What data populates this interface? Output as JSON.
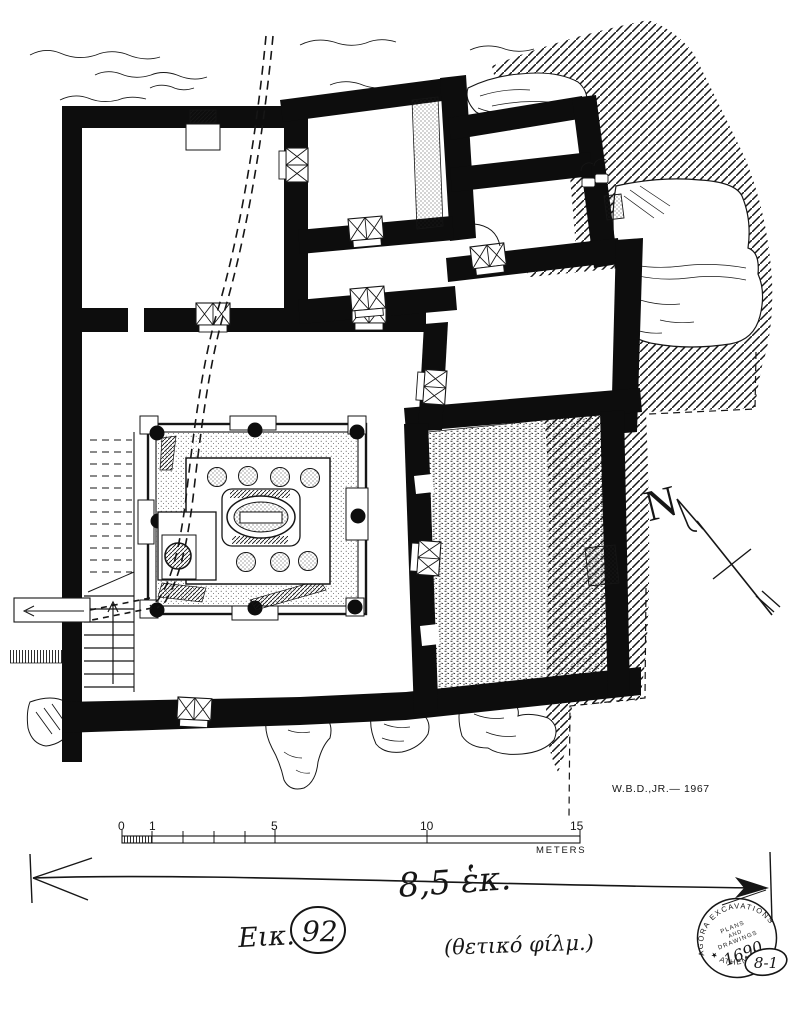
{
  "plan": {
    "credit": "W.B.D.,JR.— 1967",
    "north": {
      "label": "N"
    },
    "scale_bar": {
      "tick_labels": [
        "0",
        "1",
        "5",
        "10",
        "15"
      ],
      "unit": "METERS"
    },
    "annotations": {
      "dimension_note": "8,5 ἑκ.",
      "figure_caption_prefix": "Εικ.",
      "figure_number": "92",
      "film_note": "(θετικό φίλμ.)"
    },
    "stamp": {
      "ring_top": "AGORA EXCAVATIONS",
      "ring_bottom": "★ ATHENS ★",
      "line1": "PLANS",
      "line2": "AND",
      "line3": "DRAWINGS",
      "number": "1690",
      "catalog_note": "8-1"
    },
    "colors": {
      "ink": "#161616",
      "wall": "#0d0d0d",
      "paper": "#ffffff"
    }
  }
}
